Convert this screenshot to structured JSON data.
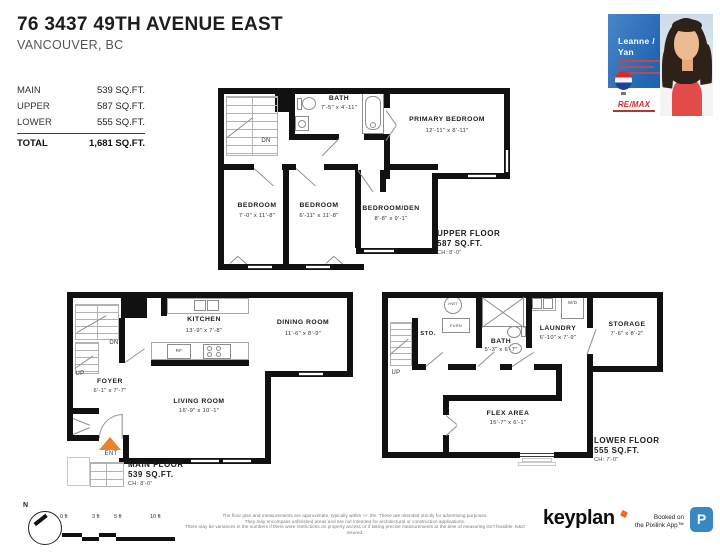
{
  "header": {
    "title": "76 3437 49TH AVENUE EAST",
    "subtitle": "VANCOUVER, BC"
  },
  "area_table": {
    "rows": [
      {
        "label": "MAIN",
        "value": "539 SQ.FT."
      },
      {
        "label": "UPPER",
        "value": "587 SQ.FT."
      },
      {
        "label": "LOWER",
        "value": "555 SQ.FT."
      }
    ],
    "total": {
      "label": "TOTAL",
      "value": "1,681 SQ.FT."
    }
  },
  "agent_card": {
    "name_line1": "Leanne /",
    "name_line2": "Yan",
    "brand": "RE/MAX"
  },
  "floors": {
    "upper": {
      "name": "UPPER FLOOR",
      "area": "587 SQ.FT.",
      "ceiling": "CH: 8'-0\"",
      "stairs_label": "DN",
      "rooms": [
        {
          "name": "BATH",
          "dims": "7'-5\" x 4'-11\""
        },
        {
          "name": "PRIMARY BEDROOM",
          "dims": "12'-11\" x 8'-11\""
        },
        {
          "name": "BEDROOM",
          "dims": "7'-0\" x 11'-8\""
        },
        {
          "name": "BEDROOM",
          "dims": "6'-11\" x 11'-8\""
        },
        {
          "name": "BEDROOM/DEN",
          "dims": "8'-8\" x 9'-1\""
        }
      ]
    },
    "main": {
      "name": "MAIN FLOOR",
      "area": "539 SQ.FT.",
      "ceiling": "CH: 8'-0\"",
      "stairs_down_label": "DN",
      "stairs_up_label": "UP",
      "entry_label": "ENT",
      "fridge_label": "RF",
      "rooms": [
        {
          "name": "KITCHEN",
          "dims": "13'-9\" x 7'-8\""
        },
        {
          "name": "DINING ROOM",
          "dims": "11'-6\" x 8'-9\""
        },
        {
          "name": "FOYER",
          "dims": "6'-1\" x 7'-7\""
        },
        {
          "name": "LIVING ROOM",
          "dims": "16'-9\" x 10'-1\""
        }
      ]
    },
    "lower": {
      "name": "LOWER FLOOR",
      "area": "555 SQ.FT.",
      "ceiling": "CH: 7'-0\"",
      "stairs_up_label": "UP",
      "storage_label": "STO.",
      "hot_water_tank_label": "HWT",
      "furnace_label": "FURN",
      "washer_dryer_label": "W/D",
      "rooms": [
        {
          "name": "BATH",
          "dims": "5'-3\" x 6'-7\""
        },
        {
          "name": "LAUNDRY",
          "dims": "6'-10\" x 7'-9\""
        },
        {
          "name": "STORAGE",
          "dims": "7'-6\" x 8'-2\""
        },
        {
          "name": "FLEX AREA",
          "dims": "15'-7\" x 6'-1\""
        }
      ]
    }
  },
  "footer": {
    "compass_label": "N",
    "scale_labels": [
      "0 ft",
      "3 ft",
      "5 ft",
      "10 ft"
    ],
    "disclaimer_lines": [
      "The floor plan and measurements are approximate, typically within +/- 2%. These are intended strictly for advertising purposes.",
      "They may encompass unfinished areas and are not intended for architectural or construction applications.",
      "There may be variances in the numbers if there were restrictions on property access or if taking precise measurements at the time of measuring isn't feasible. E&O insured."
    ],
    "brand": "keyplan",
    "booked_line1": "Booked on",
    "booked_line2": "the Pixilink App™",
    "app_icon_letter": "P"
  },
  "colors": {
    "entry_arrow": "#e8832c",
    "remax_red": "#d7282f",
    "remax_blue": "#20409a",
    "card_blue": "#2166b4",
    "keyplan_mark_orange": "#f26a21",
    "app_icon_blue": "#3788c4"
  }
}
